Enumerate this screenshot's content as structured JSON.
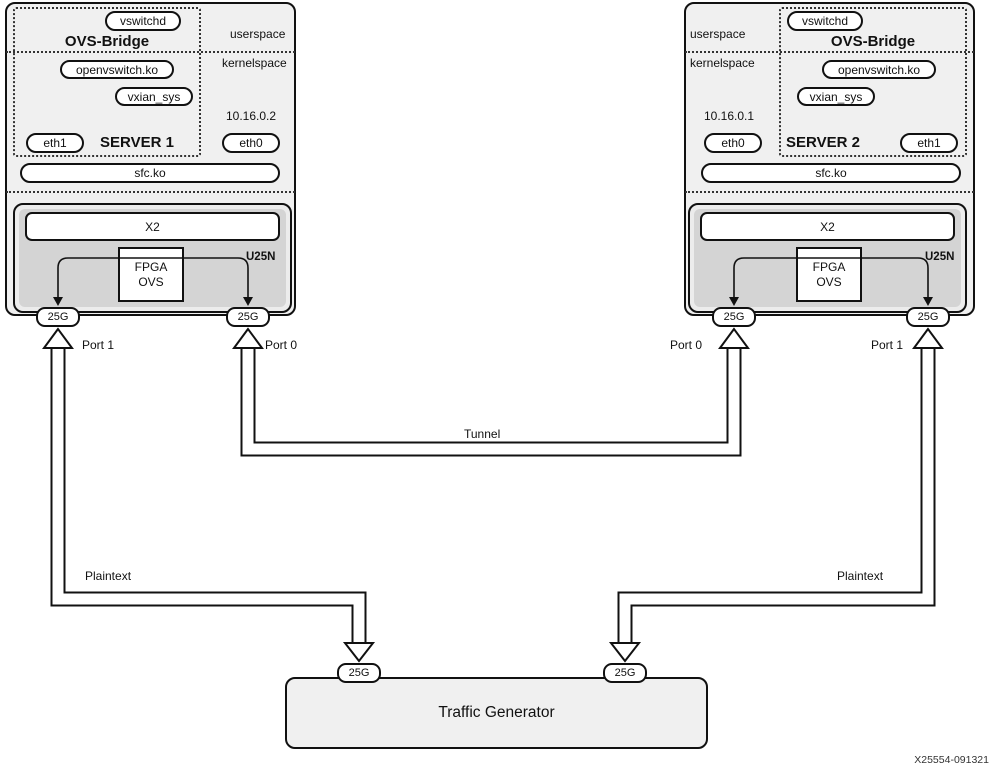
{
  "diagram": {
    "figure_id": "X25554-091321",
    "traffic_generator": {
      "label": "Traffic Generator",
      "left_port": "25G",
      "right_port": "25G"
    },
    "links": {
      "tunnel_label": "Tunnel",
      "left_plaintext_label": "Plaintext",
      "right_plaintext_label": "Plaintext"
    }
  },
  "servers": [
    {
      "name": "SERVER 1",
      "bridge_label": "OVS-Bridge",
      "vswitchd_label": "vswitchd",
      "userspace_label": "userspace",
      "kernelspace_label": "kernelspace",
      "openvswitch_label": "openvswitch.ko",
      "vxlan_label": "vxian_sys",
      "ip": "10.16.0.2",
      "left_nic": "eth1",
      "right_nic": "eth0",
      "sfc_label": "sfc.ko",
      "smartnic": {
        "label": "U25N",
        "x2_label": "X2",
        "fpga_label_line1": "FPGA",
        "fpga_label_line2": "OVS",
        "left_port_speed": "25G",
        "right_port_speed": "25G",
        "left_port_label": "Port 1",
        "right_port_label": "Port 0"
      }
    },
    {
      "name": "SERVER 2",
      "bridge_label": "OVS-Bridge",
      "vswitchd_label": "vswitchd",
      "userspace_label": "userspace",
      "kernelspace_label": "kernelspace",
      "openvswitch_label": "openvswitch.ko",
      "vxlan_label": "vxian_sys",
      "ip": "10.16.0.1",
      "left_nic": "eth0",
      "right_nic": "eth1",
      "sfc_label": "sfc.ko",
      "smartnic": {
        "label": "U25N",
        "x2_label": "X2",
        "fpga_label_line1": "FPGA",
        "fpga_label_line2": "OVS",
        "left_port_speed": "25G",
        "right_port_speed": "25G",
        "left_port_label": "Port 0",
        "right_port_label": "Port 1"
      }
    }
  ]
}
